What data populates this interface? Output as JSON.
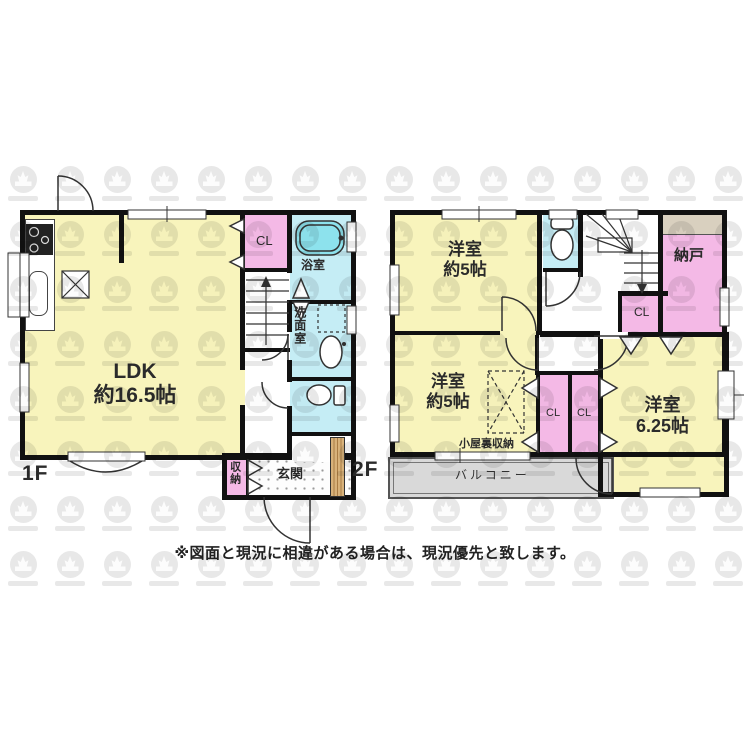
{
  "note": {
    "disclaimer": "※図面と現況に相違がある場合は、現況優先と致します。"
  },
  "colors": {
    "room_yellow": "#f8f4bc",
    "closet_pink": "#f4b9e6",
    "wet_cyan": "#c5edf5",
    "tub_cyan": "#8de2ed",
    "balcony_gray": "#d9d9d9",
    "shelf_beige": "#d9d0bf",
    "wall_black": "#111111",
    "wood_tan": "#d3a96e"
  },
  "floor1": {
    "label": "1F",
    "rooms": {
      "ldk": {
        "name": "LDK",
        "size": "約16.5帖"
      },
      "closet": "CL",
      "bath": "浴室",
      "washroom": "洗面室",
      "storage": "収納",
      "entrance": "玄関"
    }
  },
  "floor2": {
    "label": "2F",
    "rooms": {
      "western1": {
        "name": "洋室",
        "size": "約5帖"
      },
      "storeroom": "納戸",
      "closet_under_stairs": "CL",
      "western2": {
        "name": "洋室",
        "size": "約5帖"
      },
      "attic": "小屋裏収納",
      "closet_a": "CL",
      "closet_b": "CL",
      "western3": {
        "name": "洋室",
        "size": "6.25帖"
      },
      "balcony": "バルコニー"
    }
  }
}
